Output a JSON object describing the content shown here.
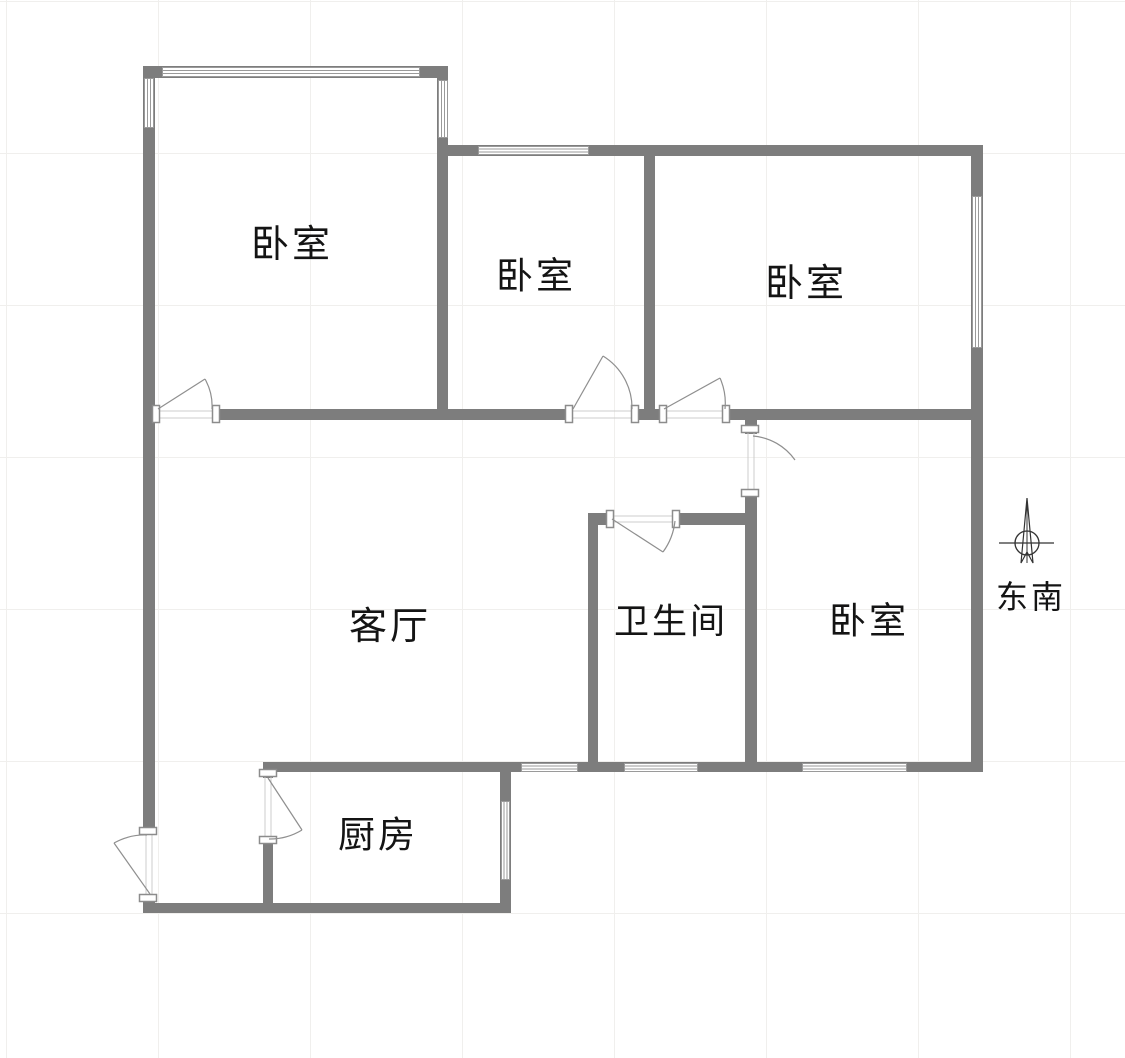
{
  "palette": {
    "wall": "#7d7d7d",
    "jamb_fill": "#ffffff",
    "jamb_stroke": "#8c8c8c",
    "window_stroke": "#9a9a9a",
    "window_fill": "#ffffff",
    "opening_line": "#cccccc",
    "door_line": "#8f8f8f",
    "compass_line": "#333333",
    "text": "#141414",
    "grid": "#f0efed"
  },
  "rooms": {
    "bedroom1": {
      "label": "卧室",
      "x": 292,
      "y": 245,
      "font": 38
    },
    "bedroom2": {
      "label": "卧室",
      "x": 536,
      "y": 277,
      "font": 37
    },
    "bedroom3": {
      "label": "卧室",
      "x": 806,
      "y": 284,
      "font": 38
    },
    "living": {
      "label": "客厅",
      "x": 390,
      "y": 627,
      "font": 38
    },
    "bathroom": {
      "label": "卫生间",
      "x": 671,
      "y": 622,
      "font": 35
    },
    "bedroom4": {
      "label": "卧室",
      "x": 869,
      "y": 622,
      "font": 37
    },
    "kitchen": {
      "label": "厨房",
      "x": 378,
      "y": 836,
      "font": 37
    }
  },
  "compass": {
    "label": "东南",
    "label_x": 1031,
    "label_y": 597,
    "font": 32,
    "cx": 1027,
    "cy": 543,
    "radius": 12,
    "cross": [
      999,
      543,
      1054,
      543
    ],
    "needle_tip": [
      1027,
      498
    ],
    "needle_left": [
      1021,
      563
    ],
    "needle_notch": [
      1027,
      552
    ],
    "needle_right": [
      1033,
      563
    ]
  },
  "floorplan": {
    "walls": [
      [
        143,
        66,
        12,
        764
      ],
      [
        143,
        896,
        12,
        17
      ],
      [
        143,
        66,
        304,
        12
      ],
      [
        437,
        66,
        11,
        353
      ],
      [
        437,
        145,
        546,
        11
      ],
      [
        971,
        145,
        12,
        627
      ],
      [
        644,
        156,
        11,
        263
      ],
      [
        143,
        409,
        14,
        11
      ],
      [
        213,
        409,
        360,
        11
      ],
      [
        633,
        409,
        31,
        11
      ],
      [
        725,
        409,
        247,
        11
      ],
      [
        745,
        409,
        12,
        25
      ],
      [
        745,
        492,
        12,
        280
      ],
      [
        588,
        513,
        24,
        12
      ],
      [
        676,
        513,
        81,
        12
      ],
      [
        588,
        513,
        10,
        259
      ],
      [
        263,
        762,
        720,
        10
      ],
      [
        263,
        762,
        10,
        16
      ],
      [
        263,
        838,
        10,
        75
      ],
      [
        500,
        772,
        11,
        141
      ],
      [
        143,
        903,
        368,
        10
      ]
    ],
    "windows": [
      {
        "x": 162,
        "y": 67,
        "w": 258,
        "h": 10,
        "dir": "h"
      },
      {
        "x": 144,
        "y": 78,
        "w": 10,
        "h": 50,
        "dir": "v"
      },
      {
        "x": 438,
        "y": 80,
        "w": 10,
        "h": 58,
        "dir": "v"
      },
      {
        "x": 478,
        "y": 146,
        "w": 111,
        "h": 9,
        "dir": "h"
      },
      {
        "x": 972,
        "y": 196,
        "w": 10,
        "h": 152,
        "dir": "v"
      },
      {
        "x": 521,
        "y": 763,
        "w": 57,
        "h": 9,
        "dir": "h"
      },
      {
        "x": 624,
        "y": 763,
        "w": 74,
        "h": 9,
        "dir": "h"
      },
      {
        "x": 802,
        "y": 763,
        "w": 105,
        "h": 9,
        "dir": "h"
      },
      {
        "x": 501,
        "y": 801,
        "w": 9,
        "h": 79,
        "dir": "v"
      }
    ],
    "jambs": [
      [
        152,
        405,
        8,
        18
      ],
      [
        212,
        405,
        8,
        18
      ],
      [
        565,
        405,
        8,
        18
      ],
      [
        631,
        405,
        8,
        18
      ],
      [
        659,
        405,
        8,
        18
      ],
      [
        722,
        405,
        8,
        18
      ],
      [
        741,
        425,
        18,
        8
      ],
      [
        741,
        489,
        18,
        8
      ],
      [
        606,
        510,
        8,
        18
      ],
      [
        672,
        510,
        8,
        18
      ],
      [
        259,
        769,
        18,
        8
      ],
      [
        259,
        836,
        18,
        8
      ],
      [
        139,
        827,
        18,
        8
      ],
      [
        139,
        894,
        18,
        8
      ]
    ],
    "opening_lines": [
      [
        160,
        411,
        212,
        411
      ],
      [
        160,
        418,
        212,
        418
      ],
      [
        573,
        411,
        631,
        411
      ],
      [
        573,
        418,
        631,
        418
      ],
      [
        667,
        411,
        722,
        411
      ],
      [
        667,
        418,
        722,
        418
      ],
      [
        748,
        433,
        748,
        489
      ],
      [
        754,
        433,
        754,
        489
      ],
      [
        614,
        516,
        672,
        516
      ],
      [
        614,
        522,
        672,
        522
      ],
      [
        265,
        777,
        265,
        836
      ],
      [
        271,
        777,
        271,
        836
      ],
      [
        146,
        835,
        146,
        894
      ],
      [
        152,
        835,
        152,
        894
      ]
    ],
    "door_leaves": [
      [
        158,
        409,
        205,
        379
      ],
      [
        573,
        409,
        603,
        356
      ],
      [
        664,
        409,
        720,
        378
      ],
      [
        612,
        519,
        663,
        552
      ],
      [
        268,
        778,
        302,
        830
      ],
      [
        150,
        894,
        114,
        843
      ]
    ],
    "door_arcs": [
      "M 205 379 A 55 55 0 0 1 212 409",
      "M 603 356 A 61 61 0 0 1 632 409",
      "M 720 378 A 62 62 0 0 1 725 409",
      "M 753 436 A 57 57 0 0 1 795 460",
      "M 663 552 A 64 64 0 0 0 675 521",
      "M 302 830 A 62 62 0 0 1 269 839",
      "M 114 843 A 63 63 0 0 1 147 835"
    ]
  }
}
